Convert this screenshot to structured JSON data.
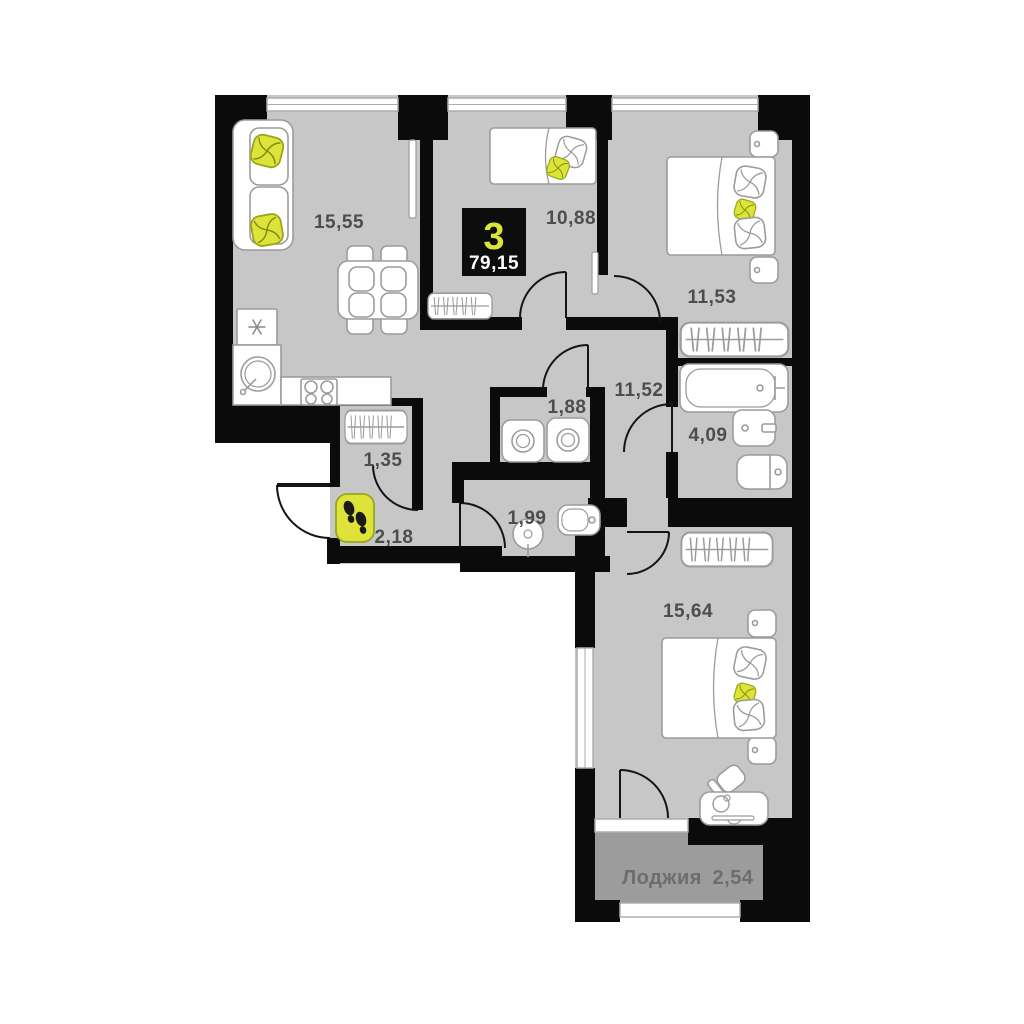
{
  "plan": {
    "type": "apartment-floor-plan",
    "badge": {
      "rooms_count": "3",
      "total_area": "79,15"
    },
    "rooms": {
      "living": {
        "name": "kitchen-living-room",
        "area": "15,55"
      },
      "bedroom_small": {
        "name": "bedroom-top-middle",
        "area": "10,88"
      },
      "bedroom_right": {
        "name": "bedroom-top-right",
        "area": "11,53"
      },
      "hallway": {
        "name": "hallway",
        "area": "11,52"
      },
      "laundry": {
        "name": "laundry-room",
        "area": "1,88"
      },
      "bathroom": {
        "name": "bathroom",
        "area": "4,09"
      },
      "closet": {
        "name": "closet",
        "area": "1,35"
      },
      "entry": {
        "name": "entry-hall",
        "area": "2,18"
      },
      "wc": {
        "name": "wc",
        "area": "1,99"
      },
      "bedroom_big": {
        "name": "bedroom-bottom",
        "area": "15,64"
      },
      "loggia": {
        "name": "loggia",
        "label": "Лоджия",
        "area": "2,54"
      }
    },
    "icons": {
      "entry_marker": "footprints-icon",
      "fridge_mark": "snowflake-icon",
      "furniture": [
        "sofa",
        "dining-table",
        "chairs",
        "fridge",
        "sink",
        "stove",
        "wardrobe",
        "radiator",
        "single-bed",
        "double-bed",
        "nightstand",
        "pillow",
        "washing-machine",
        "bathtub",
        "washbasin",
        "toilet",
        "desk",
        "desk-chair"
      ]
    },
    "colors": {
      "floor": "#c7c7c7",
      "loggia_floor": "#9c9c9c",
      "wall": "#0b0b0b",
      "furniture_stroke": "#9c9c9c",
      "accent_yellow": "#dde338",
      "accent_yellow_dark": "#9aa51c",
      "label_text": "#4d4d4d",
      "loggia_text": "#6d6d6d",
      "badge_bg": "#0d0d0d",
      "badge_number": "#d9e53a"
    }
  }
}
